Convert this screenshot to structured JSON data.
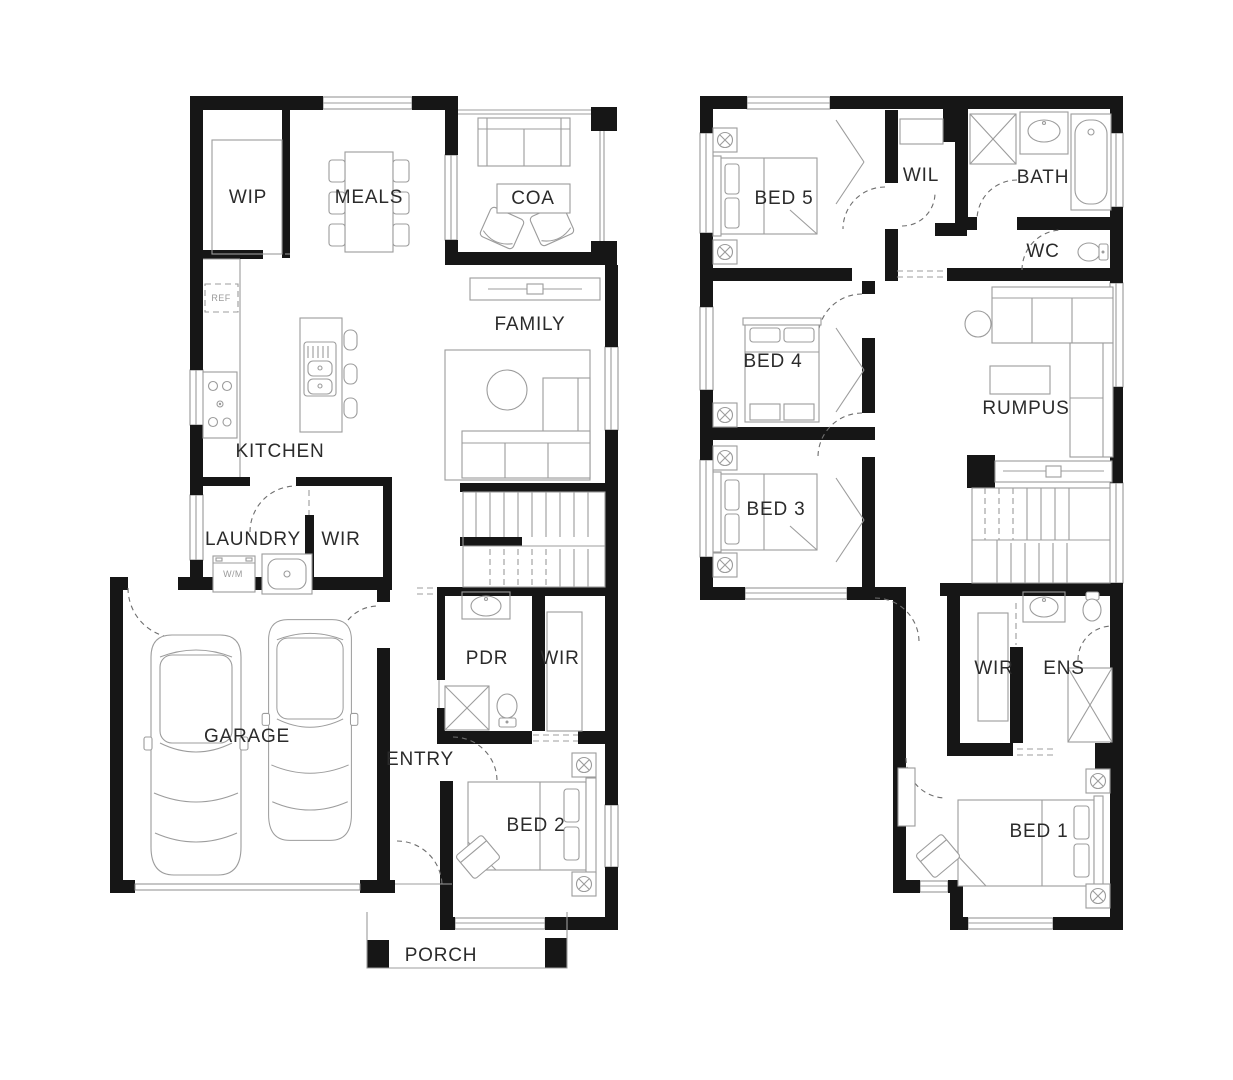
{
  "colors": {
    "wall": "#161616",
    "furniture_line": "#9c9c9c",
    "label_text": "#2b2b2b",
    "muted_text": "#9a9a9a",
    "background": "#ffffff"
  },
  "ground_floor": {
    "rooms": [
      {
        "id": "wip",
        "label": "WIP"
      },
      {
        "id": "meals",
        "label": "MEALS"
      },
      {
        "id": "coa",
        "label": "COA"
      },
      {
        "id": "family",
        "label": "FAMILY"
      },
      {
        "id": "kitchen",
        "label": "KITCHEN"
      },
      {
        "id": "laundry",
        "label": "LAUNDRY"
      },
      {
        "id": "wir",
        "label": "WIR"
      },
      {
        "id": "pdr",
        "label": "PDR"
      },
      {
        "id": "wir2",
        "label": "WIR"
      },
      {
        "id": "garage",
        "label": "GARAGE"
      },
      {
        "id": "entry",
        "label": "ENTRY"
      },
      {
        "id": "bed2",
        "label": "BED 2"
      },
      {
        "id": "porch",
        "label": "PORCH"
      }
    ],
    "appliances": {
      "fridge": "REF",
      "washer": "W/M"
    }
  },
  "upper_floor": {
    "rooms": [
      {
        "id": "bed5",
        "label": "BED 5"
      },
      {
        "id": "wil",
        "label": "WIL"
      },
      {
        "id": "bath",
        "label": "BATH"
      },
      {
        "id": "wc",
        "label": "WC"
      },
      {
        "id": "bed4",
        "label": "BED 4"
      },
      {
        "id": "rumpus",
        "label": "RUMPUS"
      },
      {
        "id": "bed3",
        "label": "BED 3"
      },
      {
        "id": "wir",
        "label": "WIR"
      },
      {
        "id": "ens",
        "label": "ENS"
      },
      {
        "id": "bed1",
        "label": "BED 1"
      }
    ]
  }
}
